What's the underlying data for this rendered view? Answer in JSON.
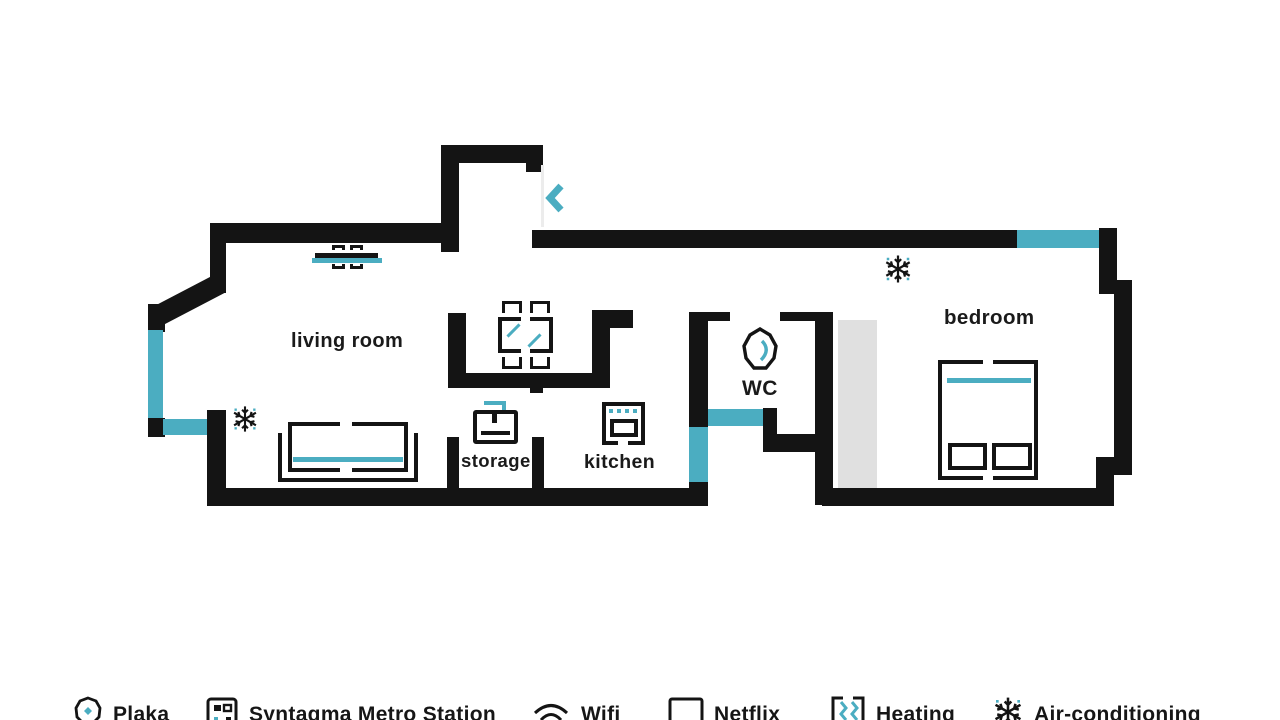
{
  "plan": {
    "rooms": {
      "living_room": "living room",
      "storage": "storage",
      "kitchen": "kitchen",
      "wc": "WC",
      "bedroom": "bedroom"
    }
  },
  "legend": {
    "items": [
      {
        "label": "Plaka",
        "icon": "plaka-pin-icon"
      },
      {
        "label": "Syntagma Metro Station",
        "icon": "metro-icon"
      },
      {
        "label": "Wifi",
        "icon": "wifi-icon"
      },
      {
        "label": "Netflix",
        "icon": "tv-icon"
      },
      {
        "label": "Heating",
        "icon": "heating-icon"
      },
      {
        "label": "Air-conditioning",
        "icon": "snowflake-icon"
      }
    ]
  },
  "colors": {
    "wall": "#141414",
    "accent": "#4badc1",
    "closet": "#e0e0e0"
  }
}
